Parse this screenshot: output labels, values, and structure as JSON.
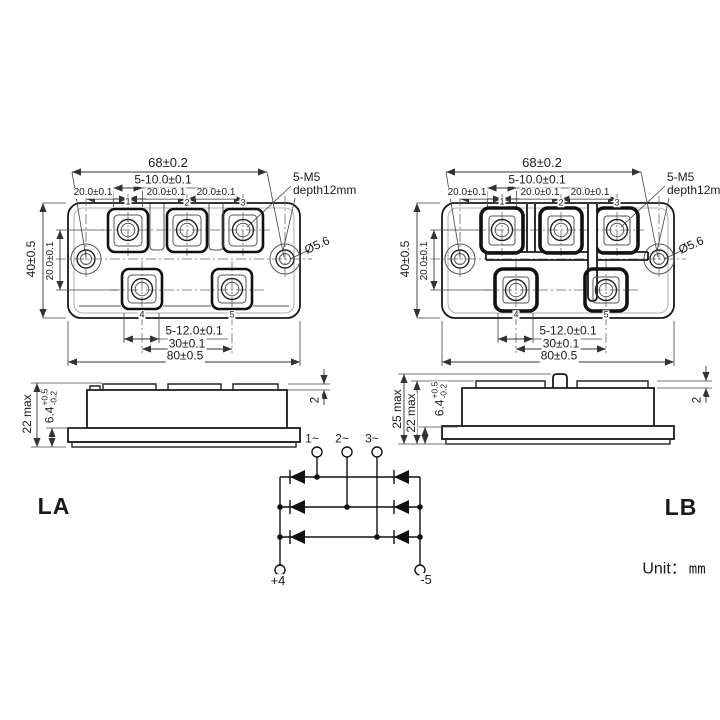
{
  "labels": {
    "la": "LA",
    "lb": "LB",
    "unit_prefix": "Unit：",
    "unit_value": "mm"
  },
  "top_view": {
    "hole_span": "68±0.2",
    "terminal_hole_width": "5-10.0±0.1",
    "pitch_left": "20.0±0.1",
    "pitch_mid": "20.0±0.1",
    "pitch_right": "20.0±0.1",
    "thread_spec": "5-M5",
    "thread_depth": "depth12mm",
    "height_overall": "40±0.5",
    "row_pitch": "20.0±0.1",
    "mount_hole_dia": "Ø5.6",
    "bottom_terminal_width": "5-12.0±0.1",
    "bottom_pitch": "30±0.1",
    "width_overall": "80±0.5",
    "terminal_numbers": [
      "1",
      "2",
      "3",
      "4",
      "5"
    ]
  },
  "side_view_la": {
    "height_max": "22 max",
    "base_thickness": "6.4",
    "base_tol_plus": "+0.5",
    "base_tol_minus": "-0.2",
    "terminal_step": "2"
  },
  "side_view_lb": {
    "overall_height_max": "25 max",
    "height_max": "22 max",
    "base_thickness": "6.4",
    "base_tol_plus": "+0.5",
    "base_tol_minus": "-0.2",
    "terminal_step": "2"
  },
  "circuit": {
    "ac_terminal_1": "1~",
    "ac_terminal_2": "2~",
    "ac_terminal_3": "3~",
    "dc_positive": "+4",
    "dc_negative": "-5"
  }
}
